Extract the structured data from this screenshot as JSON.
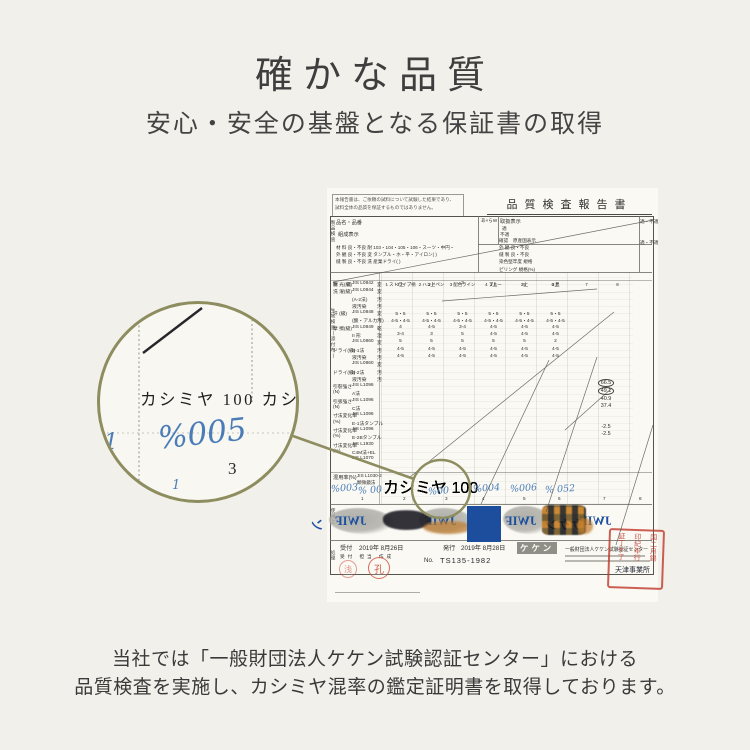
{
  "page": {
    "title": "確かな品質",
    "subtitle": "安心・安全の基盤となる保証書の取得"
  },
  "caption": {
    "line1": "当社では「一般財団法人ケケン試験認証センター」における",
    "line2": "品質検査を実施し、カシミヤ混率の鑑定証明書を取得しております。"
  },
  "colors": {
    "accent_olive": "#8d8d60",
    "hand_blue": "#4a7db8",
    "watermark_blue": "#1b4fa0",
    "stamp_red": "#c23e2e",
    "background": "#f2f0ea"
  },
  "doc": {
    "header": "品質検査報告書",
    "notice1": "本報告書は、ご依頼の試料について試験した結果であり、",
    "notice2": "試料全体の品質を保証するものではありません。",
    "hinmei": "品名・品番",
    "kumisei": "組成表示",
    "a_mark": "あ×らW",
    "toriatsukai": "取扱表示",
    "teki": "適",
    "futeki": "不適",
    "kakunin": "確認",
    "gensankoku": "原産国表示",
    "teki_futeki_1": "適・不適",
    "teki_futeki_2": "適・不適",
    "left_block_rows": [
      "材 料  良・不良  耐  103・104・105・106・スーツ・中円・",
      "外 観  良・不良  変  タンブル・ホ・平・アイロン(   )",
      "縫 製  良・不良  洗  産業ドライ(   )"
    ],
    "right_block_rows": [
      "外 観  良・不良",
      "縫 製  良・不良",
      "染色堅牢度  規格",
      "ピリング  規格(%)"
    ],
    "koumoku": "項 目",
    "col_headers": [
      "1 ストライプ柄",
      "2 ハンドペン",
      "3 配色ライン",
      "4 ブルー",
      "5",
      "6 黒",
      "7",
      "8"
    ],
    "vert_label_1": "製品検査",
    "vert_label_2": "生地検査(添付布)",
    "vert_label_3": "使用上",
    "vert_label_4": "処理",
    "rows": [
      {
        "l": "耐 光(級)",
        "j": "JIS L0842",
        "m": "変",
        "v": [
          "3上",
          "3上",
          "3",
          "3上",
          "3上",
          "3上",
          "",
          ""
        ]
      },
      {
        "l": "洗 濯(級)",
        "j": "JIS L0844",
        "m": "変",
        "v": []
      },
      {
        "l": "",
        "j": "(A-2法)",
        "m": "汚",
        "v": []
      },
      {
        "l": "",
        "j": "液汚染",
        "m": "汚",
        "v": []
      },
      {
        "l": "汗 (級)",
        "j": "JIS L0848",
        "m": "変",
        "v": [
          "5・5",
          "5・5",
          "5・5",
          "5・5",
          "5・5",
          "5・5",
          "",
          ""
        ]
      },
      {
        "l": "",
        "j": "(酸・アルカリ)",
        "m": "汚",
        "v": [
          "4-5・4-5",
          "4-5・4-5",
          "4-5・4-5",
          "4-5・4-5",
          "4-5・4-5",
          "4-5・4-5",
          "",
          ""
        ]
      },
      {
        "l": "摩 擦(級)",
        "j": "JIS L0849",
        "m": "乾",
        "v": [
          "4",
          "4-5",
          "3-4",
          "4-5",
          "4-5",
          "4-5",
          "",
          ""
        ]
      },
      {
        "l": "",
        "j": "II 形",
        "m": "湿",
        "v": [
          "3-4",
          "3",
          "5",
          "4-5",
          "4-5",
          "4-5",
          "",
          ""
        ]
      },
      {
        "l": "",
        "j": "JIS L0860",
        "m": "変",
        "v": [
          "5",
          "5",
          "5",
          "5",
          "5",
          "2",
          "",
          ""
        ]
      },
      {
        "l": "ドライ(級)",
        "j": "B-1法",
        "m": "汚",
        "v": [
          "4-5",
          "4-5",
          "4-5",
          "4-5",
          "4-5",
          "4-5",
          "",
          ""
        ]
      },
      {
        "l": "",
        "j": "液汚染",
        "m": "汚",
        "v": [
          "4-5",
          "4-5",
          "4-5",
          "4-5",
          "4-5",
          "4-5",
          "",
          ""
        ]
      },
      {
        "l": "",
        "j": "JIS L0860",
        "m": "変",
        "v": []
      },
      {
        "l": "ドライ(級)",
        "j": "B-2法",
        "m": "汚",
        "v": []
      },
      {
        "l": "",
        "j": "液汚染",
        "m": "汚",
        "v": []
      },
      {
        "l": "引裂強さ",
        "j": "JIS L1096",
        "m": "",
        "v": []
      },
      {
        "l": "(N)",
        "j": "A法",
        "m": "",
        "v": []
      },
      {
        "l": "引張強さ",
        "j": "JIS L1096",
        "m": "",
        "v": []
      },
      {
        "l": "(N)",
        "j": "C法",
        "m": "",
        "v": []
      },
      {
        "l": "寸法変化率",
        "j": "JIS L1096",
        "m": "",
        "v": []
      },
      {
        "l": "(%)",
        "j": "E-1法タンブル",
        "m": "",
        "v": []
      },
      {
        "l": "寸法変化率",
        "j": "JIS L1096",
        "m": "",
        "v": []
      },
      {
        "l": "(%)",
        "j": "E-2Bタンブル",
        "m": "",
        "v": []
      },
      {
        "l": "寸法変化率",
        "j": "JIS L1930",
        "m": "",
        "v": []
      },
      {
        "l": "(%)",
        "j": "C4M法+EL",
        "m": "",
        "v": []
      },
      {
        "l": "",
        "j": "JIS L1070",
        "m": "",
        "v": []
      }
    ],
    "measurements": {
      "circled1": "66.5",
      "circled2": "49.1",
      "plain1": "40.9",
      "plain2": "37.4",
      "lower1": "-2.5",
      "lower2": "-2.5"
    },
    "mixing": {
      "label": "混用率(%)",
      "jis": "JIS L1030-2",
      "method": "顕微鏡法",
      "values": [
        "カシミヤ 100",
        "カシミヤ 100",
        "カシミヤ 100",
        "カシミヤ 100",
        "カシミヤ 100",
        "カシミヤ 100",
        "",
        ""
      ],
      "handwritten": [
        {
          "t": "%003",
          "x": 4,
          "y": 295
        },
        {
          "t": "% 00",
          "x": 31,
          "y": 297
        },
        {
          "t": "%00",
          "x": 101,
          "y": 298
        },
        {
          "t": "%004",
          "x": 146,
          "y": 295
        },
        {
          "t": "%006",
          "x": 183,
          "y": 295
        },
        {
          "t": "% 052",
          "x": 218,
          "y": 296
        }
      ],
      "colnums": [
        {
          "t": "1",
          "x": 34,
          "y": 308
        },
        {
          "t": "2",
          "x": 76,
          "y": 308
        },
        {
          "t": "3",
          "x": 118,
          "y": 308
        },
        {
          "t": "4",
          "x": 155,
          "y": 308
        },
        {
          "t": "5",
          "x": 196,
          "y": 308
        },
        {
          "t": "6",
          "x": 231,
          "y": 308
        },
        {
          "t": "7",
          "x": 276,
          "y": 308
        },
        {
          "t": "8",
          "x": 312,
          "y": 308
        }
      ]
    },
    "band": [
      {
        "k": "wmark",
        "t": "ン",
        "x": -16,
        "y": 326
      },
      {
        "k": "blob",
        "x": 2,
        "y": 320,
        "w": 64,
        "h": 26
      },
      {
        "k": "wmark",
        "t": "JWIF",
        "x": 8,
        "y": 326
      },
      {
        "k": "scribble",
        "x": 56,
        "y": 322,
        "w": 48,
        "h": 20
      },
      {
        "k": "blob",
        "x": 92,
        "y": 320,
        "w": 54,
        "h": 26
      },
      {
        "k": "stain",
        "x": 96,
        "y": 333,
        "w": 50,
        "h": 13
      },
      {
        "k": "wmark",
        "t": "JWIF",
        "x": 98,
        "y": 326
      },
      {
        "k": "bluebox",
        "x": 140,
        "y": 318,
        "w": 34,
        "h": 36
      },
      {
        "k": "blob",
        "x": 176,
        "y": 318,
        "w": 48,
        "h": 28
      },
      {
        "k": "wmark",
        "t": "JWIF",
        "x": 178,
        "y": 326
      },
      {
        "k": "checker",
        "x": 215,
        "y": 317,
        "w": 44,
        "h": 30
      },
      {
        "k": "wmark",
        "t": "ケケン",
        "x": 218,
        "y": 326
      },
      {
        "k": "stain",
        "x": 250,
        "y": 330,
        "w": 16,
        "h": 16
      },
      {
        "k": "wmark",
        "t": "JWIF",
        "x": 253,
        "y": 326
      }
    ],
    "footer": {
      "uketsuke_label": "受付",
      "uketsuke_date": "2019年 8月26日",
      "hakko_label": "発行",
      "hakko_date": "2019年 8月28日",
      "roles": "受付  担当  作成",
      "stamp1": "浅",
      "stamp2": "孔",
      "no_label": "No.",
      "no_value": "TS135-1982",
      "keken_box": "ケケン",
      "org": "一般財団法人ケケン試験認証センター",
      "office": "天津事業所",
      "sq_stamp_cols": [
        "国二月錫",
        "印紀年行",
        "証丁ケ了"
      ]
    }
  },
  "magnifier": {
    "line": "カシミヤ  100  カシ",
    "hand": "%005",
    "num": "3",
    "mark": "1",
    "tick": "1"
  }
}
